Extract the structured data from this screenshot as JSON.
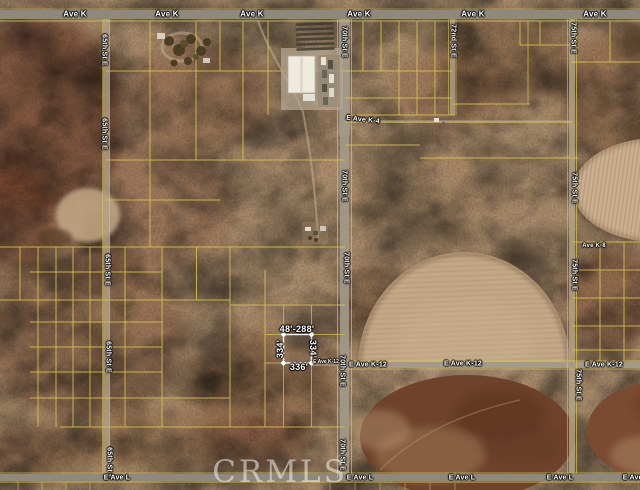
{
  "streets": {
    "ave_k": "Ave K",
    "e_ave_k4": "E Ave K-4",
    "ave_k8": "Ave K-8",
    "e_ave_k12": "E Ave K-12",
    "e_ave_l": "E Ave L",
    "st_65th": "65th St E",
    "st_70th": "70th St E",
    "st_72nd": "72nd St E",
    "st_75th": "75th St E"
  },
  "subject_parcel": {
    "top_dimension": "48'-288'",
    "left_dimension": "334'",
    "right_dimension": "334'",
    "bottom_dimension": "336'"
  },
  "watermark": "CRMLS",
  "colors": {
    "parcel_line": "#d9c447",
    "subject_outline": "#ffffff",
    "label_text": "#ffffff",
    "desert_base": "#a98c6c",
    "road_gray": "#8f897b",
    "field_light": "#c3a987",
    "field_dark": "#6e422b"
  }
}
